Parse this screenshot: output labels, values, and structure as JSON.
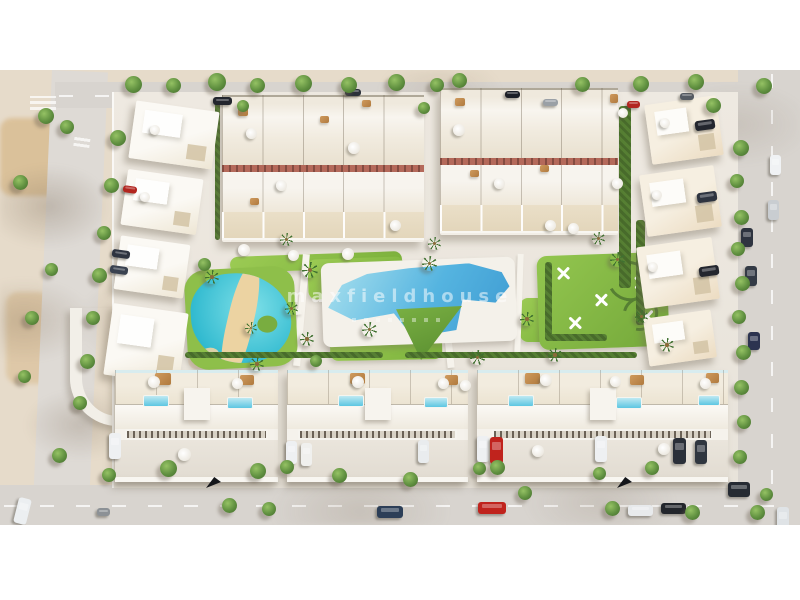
{
  "meta": {
    "description": "Aerial 3D architectural render of a residential development: townhouse blocks and villas around a communal garden with a lagoon-style pool, a large main pool, lawns, palm trees and a playground, bordered by roads with parked cars."
  },
  "watermark": {
    "text": "maxfieldhouse"
  },
  "palette": {
    "frame": "#ffffff",
    "sand": "#e6dbca",
    "sand_dark": "#d9bd92",
    "road": "#d8d4cf",
    "pavement": "#e8e3da",
    "building_white": "#fbf9f4",
    "building_cream": "#eee6d4",
    "building_beige": "#f6efe1",
    "brick": "#b4695a",
    "lawn": "#9ccb54",
    "lawn_dark": "#7cb23c",
    "hedge": "#567f33",
    "tree": "#609040",
    "lagoon": "#2fb9cf",
    "pool_blue": "#3e9bd2",
    "pool_light": "#a8e0ee",
    "beach": "#ecd3a2",
    "watermark": "rgba(255,255,255,0.52)"
  },
  "scene": {
    "trees": [
      [
        125,
        6,
        17
      ],
      [
        166,
        8,
        15
      ],
      [
        208,
        3,
        18
      ],
      [
        250,
        8,
        15
      ],
      [
        295,
        5,
        17
      ],
      [
        341,
        7,
        16
      ],
      [
        388,
        4,
        17
      ],
      [
        430,
        8,
        14
      ],
      [
        452,
        3,
        15
      ],
      [
        575,
        7,
        15
      ],
      [
        633,
        6,
        16
      ],
      [
        688,
        4,
        16
      ],
      [
        756,
        8,
        16
      ],
      [
        237,
        30,
        12
      ],
      [
        418,
        32,
        12
      ],
      [
        706,
        28,
        15
      ],
      [
        733,
        70,
        16
      ],
      [
        730,
        104,
        14
      ],
      [
        734,
        140,
        15
      ],
      [
        731,
        172,
        14
      ],
      [
        735,
        206,
        15
      ],
      [
        732,
        240,
        14
      ],
      [
        736,
        275,
        15
      ],
      [
        734,
        310,
        15
      ],
      [
        737,
        345,
        14
      ],
      [
        733,
        380,
        14
      ],
      [
        38,
        38,
        16
      ],
      [
        60,
        50,
        14
      ],
      [
        13,
        105,
        15
      ],
      [
        110,
        60,
        16
      ],
      [
        104,
        108,
        15
      ],
      [
        97,
        156,
        14
      ],
      [
        92,
        198,
        15
      ],
      [
        86,
        241,
        14
      ],
      [
        80,
        284,
        15
      ],
      [
        73,
        326,
        14
      ],
      [
        45,
        193,
        13
      ],
      [
        25,
        241,
        14
      ],
      [
        18,
        300,
        13
      ],
      [
        52,
        378,
        15
      ],
      [
        102,
        398,
        14
      ],
      [
        160,
        390,
        17
      ],
      [
        250,
        393,
        16
      ],
      [
        222,
        428,
        15
      ],
      [
        262,
        432,
        14
      ],
      [
        280,
        390,
        14
      ],
      [
        332,
        398,
        15
      ],
      [
        403,
        402,
        15
      ],
      [
        473,
        392,
        13
      ],
      [
        490,
        390,
        15
      ],
      [
        518,
        416,
        14
      ],
      [
        593,
        397,
        13
      ],
      [
        605,
        431,
        15
      ],
      [
        645,
        391,
        14
      ],
      [
        685,
        435,
        15
      ],
      [
        750,
        435,
        15
      ],
      [
        760,
        418,
        13
      ],
      [
        198,
        188,
        13
      ],
      [
        310,
        285,
        12
      ]
    ],
    "palms": [
      [
        302,
        192,
        16
      ],
      [
        362,
        252,
        15
      ],
      [
        300,
        262,
        14
      ],
      [
        422,
        186,
        15
      ],
      [
        470,
        280,
        15
      ],
      [
        520,
        242,
        14
      ],
      [
        548,
        278,
        14
      ],
      [
        610,
        182,
        15
      ],
      [
        660,
        268,
        14
      ],
      [
        250,
        287,
        14
      ],
      [
        205,
        200,
        14
      ],
      [
        285,
        232,
        13
      ],
      [
        635,
        240,
        13
      ],
      [
        280,
        163,
        13
      ],
      [
        428,
        167,
        13
      ],
      [
        592,
        162,
        13
      ],
      [
        245,
        252,
        12
      ]
    ],
    "umbrellas": [
      [
        246,
        58,
        11
      ],
      [
        276,
        110,
        11
      ],
      [
        348,
        72,
        12
      ],
      [
        390,
        150,
        11
      ],
      [
        453,
        54,
        12
      ],
      [
        494,
        108,
        11
      ],
      [
        568,
        153,
        11
      ],
      [
        612,
        108,
        11
      ],
      [
        618,
        38,
        10
      ],
      [
        238,
        174,
        12
      ],
      [
        288,
        180,
        11
      ],
      [
        342,
        178,
        12
      ],
      [
        545,
        150,
        11
      ],
      [
        150,
        55,
        10
      ],
      [
        140,
        122,
        10
      ],
      [
        660,
        48,
        10
      ],
      [
        652,
        120,
        10
      ],
      [
        648,
        192,
        10
      ],
      [
        148,
        306,
        12
      ],
      [
        232,
        308,
        11
      ],
      [
        352,
        306,
        12
      ],
      [
        438,
        308,
        11
      ],
      [
        460,
        310,
        11
      ],
      [
        540,
        304,
        12
      ],
      [
        610,
        306,
        11
      ],
      [
        700,
        308,
        11
      ],
      [
        178,
        378,
        13
      ],
      [
        532,
        375,
        12
      ],
      [
        658,
        373,
        12
      ]
    ],
    "villa_pools": [
      [
        143,
        325,
        26,
        12
      ],
      [
        227,
        327,
        26,
        12
      ],
      [
        338,
        325,
        26,
        12
      ],
      [
        424,
        327,
        24,
        11
      ],
      [
        508,
        325,
        26,
        12
      ],
      [
        616,
        327,
        26,
        12
      ],
      [
        698,
        325,
        22,
        11
      ]
    ],
    "decks": [
      [
        238,
        38,
        10,
        8
      ],
      [
        320,
        46,
        9,
        7
      ],
      [
        362,
        30,
        9,
        7
      ],
      [
        455,
        28,
        10,
        8
      ],
      [
        540,
        95,
        9,
        7
      ],
      [
        610,
        24,
        8,
        9
      ],
      [
        250,
        128,
        9,
        7
      ],
      [
        470,
        100,
        9,
        7
      ],
      [
        155,
        303,
        16,
        12
      ],
      [
        240,
        305,
        14,
        10
      ],
      [
        350,
        303,
        15,
        11
      ],
      [
        445,
        305,
        13,
        10
      ],
      [
        525,
        303,
        15,
        11
      ],
      [
        630,
        305,
        14,
        10
      ],
      [
        706,
        303,
        13,
        10
      ]
    ],
    "cars": [
      [
        213,
        27,
        19,
        8,
        "#23262e",
        0
      ],
      [
        345,
        19,
        16,
        7,
        "#2c313a",
        0
      ],
      [
        505,
        21,
        15,
        7,
        "#1c1f26",
        0
      ],
      [
        543,
        29,
        15,
        7,
        "#9aa0a6",
        0
      ],
      [
        627,
        31,
        13,
        7,
        "#b22620",
        0
      ],
      [
        680,
        23,
        14,
        7,
        "#555b63",
        0
      ],
      [
        123,
        116,
        14,
        7,
        "#b22620",
        8
      ],
      [
        112,
        180,
        18,
        8,
        "#2e3440",
        8
      ],
      [
        110,
        196,
        18,
        8,
        "#3a4250",
        8
      ],
      [
        16,
        428,
        13,
        26,
        "#eceff1",
        14
      ],
      [
        97,
        438,
        13,
        8,
        "#8c9196",
        0
      ],
      [
        377,
        436,
        26,
        12,
        "#2c3e57",
        0
      ],
      [
        478,
        432,
        28,
        12,
        "#c0231d",
        0
      ],
      [
        628,
        435,
        25,
        11,
        "#e8eaec",
        0
      ],
      [
        661,
        433,
        25,
        11,
        "#23262c",
        0
      ],
      [
        777,
        437,
        12,
        26,
        "#dfe3e6",
        0
      ],
      [
        770,
        85,
        11,
        20,
        "#f0f2f4",
        0
      ],
      [
        768,
        130,
        11,
        20,
        "#c9cdd1",
        0
      ],
      [
        695,
        50,
        20,
        10,
        "#23262e",
        -8
      ],
      [
        697,
        122,
        20,
        10,
        "#2e3440",
        -8
      ],
      [
        699,
        196,
        20,
        10,
        "#23262e",
        -8
      ],
      [
        741,
        158,
        12,
        19,
        "#2e3440",
        0
      ],
      [
        745,
        196,
        12,
        20,
        "#333a45",
        0
      ],
      [
        748,
        262,
        12,
        18,
        "#2c3350",
        0
      ],
      [
        728,
        412,
        22,
        15,
        "#262b33",
        0
      ],
      [
        109,
        363,
        12,
        26,
        "#eef0f2",
        0
      ],
      [
        286,
        371,
        11,
        23,
        "#eef0f2",
        0
      ],
      [
        301,
        373,
        11,
        23,
        "#f0f0ee",
        0
      ],
      [
        418,
        370,
        11,
        23,
        "#e9ecee",
        0
      ],
      [
        477,
        366,
        12,
        26,
        "#eef0f2",
        0
      ],
      [
        490,
        367,
        13,
        27,
        "#c0231d",
        0
      ],
      [
        595,
        366,
        12,
        26,
        "#eef0f2",
        0
      ],
      [
        673,
        368,
        13,
        26,
        "#2a2f38",
        0
      ],
      [
        695,
        370,
        12,
        24,
        "#30363f",
        0
      ]
    ],
    "markers": [
      [
        206,
        407
      ],
      [
        617,
        407
      ]
    ]
  }
}
